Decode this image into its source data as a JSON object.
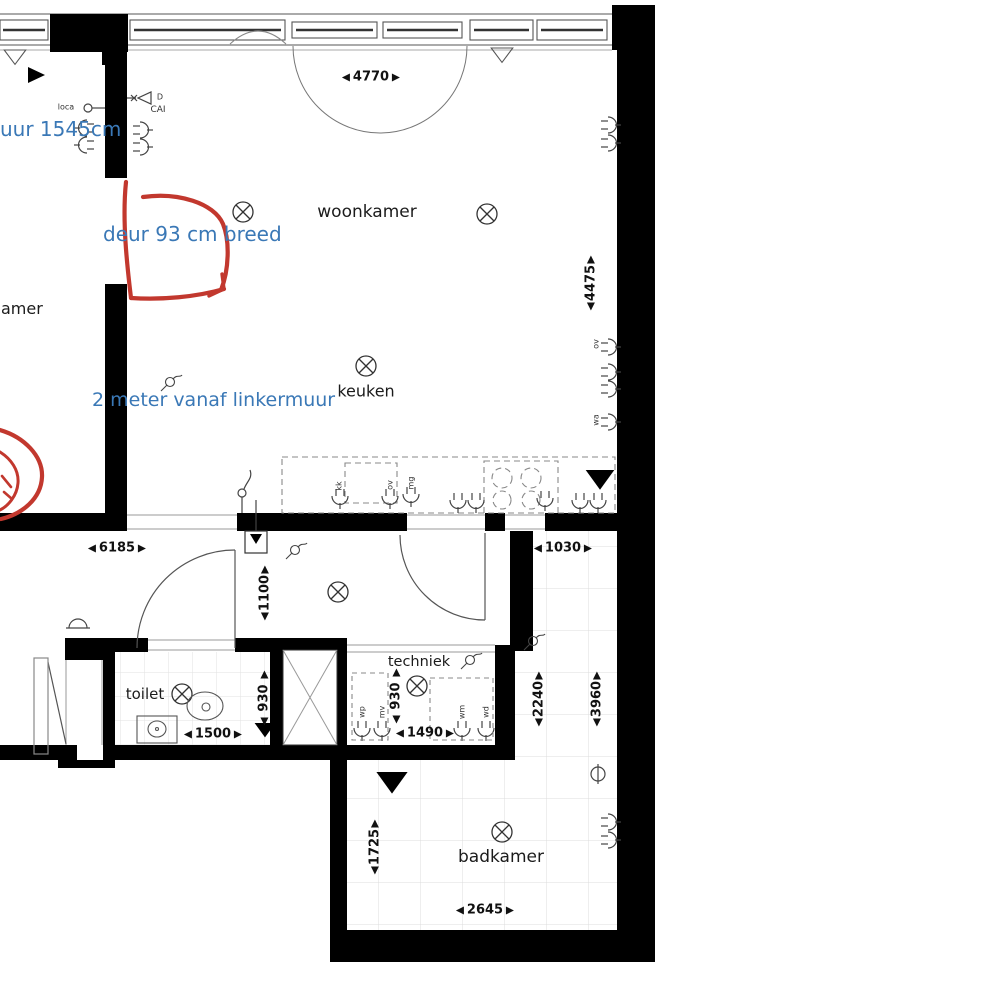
{
  "annotations": {
    "wall_note": "uur 1545cm",
    "door_note": "deur 93 cm breed",
    "kitchen_note": "2 meter vanaf linkermuur"
  },
  "rooms": {
    "partial": "amer",
    "woonkamer": "woonkamer",
    "keuken": "keuken",
    "toilet": "toilet",
    "techniek": "techniek",
    "badkamer": "badkamer"
  },
  "dims": {
    "top_width": "4770",
    "living_height": "4475",
    "hall_width": "6185",
    "corridor_width": "1030",
    "hall_depth": "1100",
    "toilet_height": "930",
    "toilet_width": "1500",
    "techniek_height": "930",
    "techniek_width": "1490",
    "bath_upper_height": "2240",
    "bath_right_height": "3960",
    "bath_lower_height": "1725",
    "bath_width": "2645"
  },
  "labels": {
    "loca": "loca",
    "cai": "CAI",
    "d": "D",
    "kk": "kk",
    "ov": "ov",
    "mg": "mg",
    "wp": "wp",
    "mv": "mv",
    "wm": "wm",
    "wd": "wd",
    "ov2": "ov",
    "wa": "wa"
  },
  "colors": {
    "annotation_blue": "#3A78B6",
    "markup_red": "#C2382E",
    "wall_black": "#000000",
    "tile_gray": "#DCDCDC"
  }
}
